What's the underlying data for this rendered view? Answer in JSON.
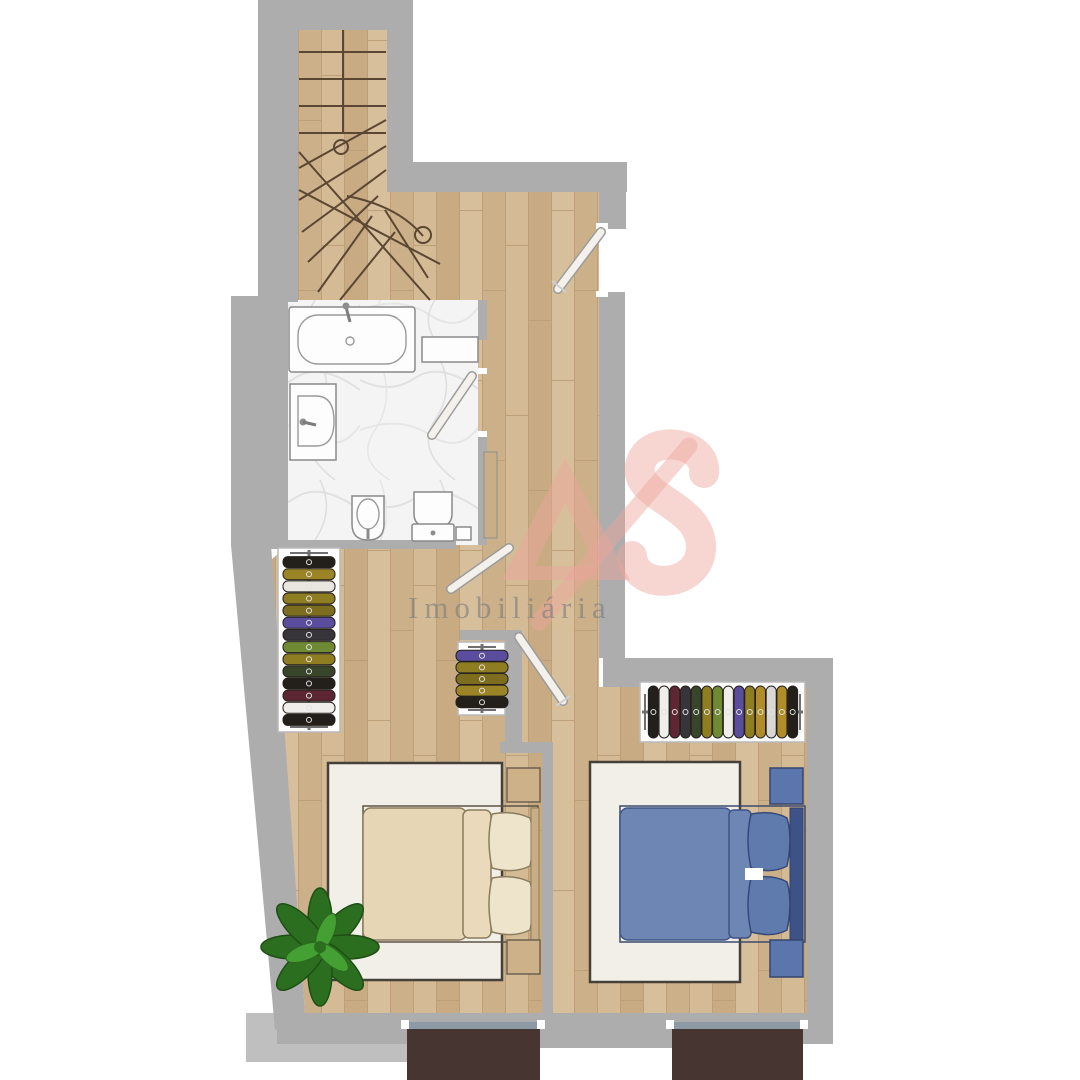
{
  "image": {
    "kind": "architectural-floor-plan",
    "width": 1080,
    "height": 1080
  },
  "watermark": {
    "brand": "AS",
    "label": "Imobiliária"
  },
  "colors": {
    "wall": "#adadad",
    "wall_light": "#bfbfbf",
    "wood_base": "#d2b791",
    "marble_base": "#f4f4f4",
    "rug": "#f2efe8",
    "bed_beige": "#e6d6b5",
    "bed_beige_fold": "#ead9bb",
    "pillow_beige": "#eee3cb",
    "headboard_beige": "#c9ad85",
    "bed_blue": "#6e86b4",
    "pillow_blue": "#5f7aac",
    "headboard_blue": "#3d5388",
    "nightstand_wood": "#cdb189",
    "nightstand_blue": "#5b76ad",
    "balcony": "#463530",
    "balcony_glass": "#8d9aa6",
    "plant_dark": "#2c6e20",
    "plant_light": "#45a033",
    "stair_line": "#5a4632",
    "logo": "#eda49b"
  },
  "racks": {
    "left": {
      "orient": "v",
      "x": 309,
      "y0": 556,
      "y1": 726,
      "colors": [
        "#23201c",
        "#9a8425",
        "#e8e6df",
        "#8f7d22",
        "#7c6d1f",
        "#5a4d9e",
        "#37343a",
        "#6e8a33",
        "#8f7d22",
        "#39452a",
        "#23201c",
        "#5c2633",
        "#efeeea",
        "#23201c"
      ]
    },
    "small": {
      "orient": "v",
      "x": 482,
      "y0": 650,
      "y1": 708,
      "colors": [
        "#5a4d9e",
        "#8f7d22",
        "#7c6d1f",
        "#9a8425",
        "#23201c"
      ]
    },
    "right": {
      "orient": "h",
      "y": 712,
      "x0": 648,
      "x1": 798,
      "colors": [
        "#23201c",
        "#efeeea",
        "#5c2633",
        "#37343a",
        "#39452a",
        "#8f7d22",
        "#6e8a33",
        "#efeeea",
        "#5a4d9e",
        "#8f7d22",
        "#b08d28",
        "#d9d8d4",
        "#b08d28",
        "#23201c"
      ]
    }
  },
  "rooms": [
    "stairs",
    "bathroom",
    "hallway",
    "bedroom-left",
    "bedroom-right"
  ],
  "fixtures": [
    "bathtub",
    "sink",
    "bidet",
    "toilet",
    "wardrobe-left",
    "wardrobe-small",
    "wardrobe-right",
    "double-bed-beige",
    "double-bed-blue",
    "plant"
  ],
  "balconies": {
    "count": 2
  }
}
